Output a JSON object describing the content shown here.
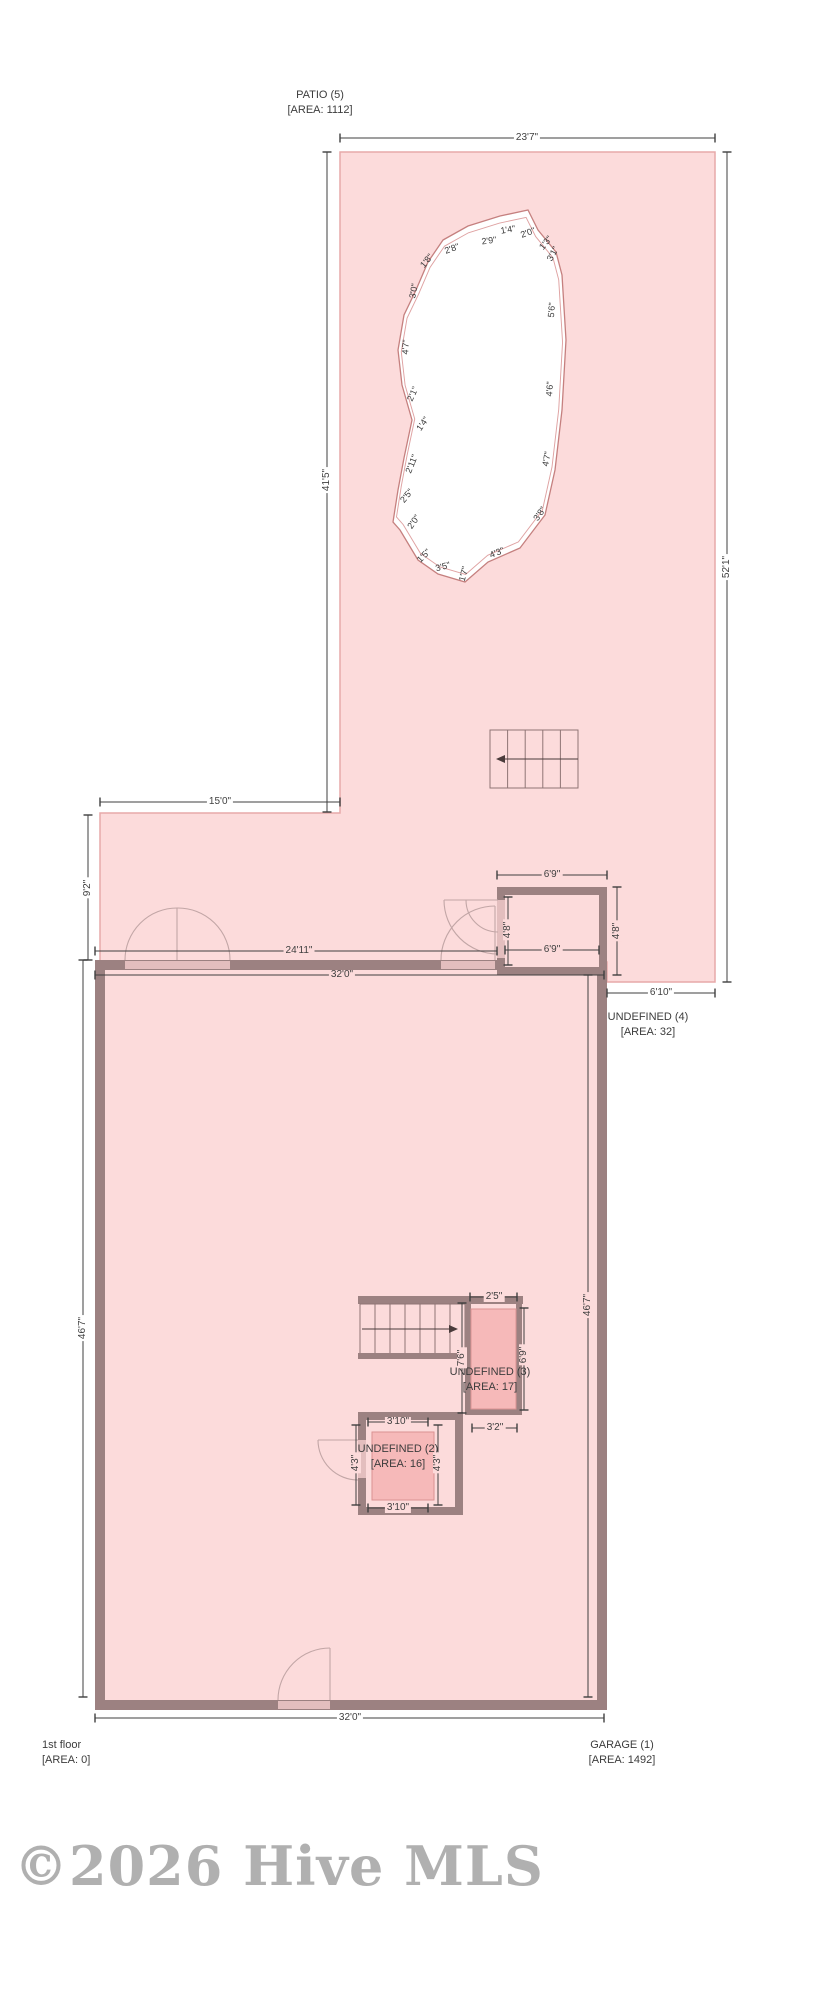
{
  "fp": {
    "patio_label": {
      "name": "PATIO (5)",
      "area": "[AREA: 1112]"
    },
    "undefined4": {
      "name": "UNDEFINED (4)",
      "area": "[AREA: 32]"
    },
    "undefined3": {
      "name": "UNDEFINED (3)",
      "area": "[AREA: 17]"
    },
    "undefined2": {
      "name": "UNDEFINED (2)",
      "area": "[AREA: 16]"
    },
    "first_floor": {
      "name": "1st floor",
      "area": "[AREA: 0]"
    },
    "garage": {
      "name": "GARAGE (1)",
      "area": "[AREA: 1492]"
    },
    "dims": {
      "patio_top": "23'7\"",
      "patio_left": "41'5\"",
      "patio_right": "52'1\"",
      "ext_top": "15'0\"",
      "ext_left": "9'2\"",
      "room4_top": "6'9\"",
      "room4_bottom": "6'9\"",
      "room4_left": "4'8\"",
      "room4_right": "4'8\"",
      "floor_top_inner": "24'11\"",
      "floor_top": "32'0\"",
      "patio_strip": "6'10\"",
      "floor_left": "46'7\"",
      "floor_right": "46'7\"",
      "room3_top": "2'5\"",
      "room3_left": "7'6\"",
      "room3_right": "6'9\"",
      "room3_bottom": "3'2\"",
      "room2_top": "3'10\"",
      "room2_left": "4'3\"",
      "room2_right": "4'3\"",
      "room2_bottom": "3'10\"",
      "floor_bottom": "32'0\""
    },
    "pool_labels": [
      "2'8\"",
      "2'9\"",
      "1'4\"",
      "2'0\"",
      "1'3\"",
      "3'1\"",
      "5'6\"",
      "4'6\"",
      "4'7\"",
      "3'8\"",
      "4'3\"",
      "1'7\"",
      "3'5\"",
      "1'5\"",
      "2'0\"",
      "2'5\"",
      "2'11\"",
      "1'4\"",
      "2'1\"",
      "4'7\"",
      "3'0\"",
      "1'8\""
    ],
    "watermark": "©2026 Hive MLS",
    "colors": {
      "patio_fill": "#fcdbdb",
      "patio_edge": "#e7a9a9",
      "wall": "#9c8181",
      "wall_opening": "#e3bebe",
      "pool_outline": "#c5807f",
      "pool_inner_outline": "#dfa2a2",
      "room_highlight": "#f6b9b9",
      "dim_text": "#3f3f3f",
      "watermark_gray": "#a3a3a3"
    }
  }
}
